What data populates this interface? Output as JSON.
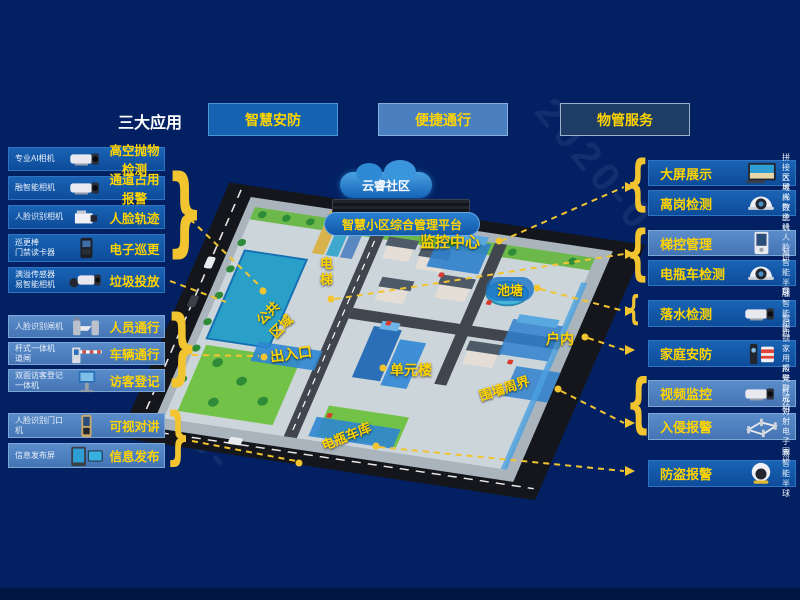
{
  "header": {
    "title": "三大应用",
    "apps": [
      {
        "label": "智慧安防"
      },
      {
        "label": "便捷通行"
      },
      {
        "label": "物管服务"
      }
    ]
  },
  "left_rows": [
    {
      "device": "专业AI相机",
      "icon": "bullet-cam",
      "label": "高空抛物检测",
      "tone": "medium"
    },
    {
      "device": "融智能相机",
      "icon": "bullet-cam",
      "label": "通道占用报警",
      "tone": "medium"
    },
    {
      "device": "人脸识别相机",
      "icon": "box-cam",
      "label": "人脸轨迹",
      "tone": "medium"
    },
    {
      "device": "巡更棒\n门禁读卡器",
      "icon": "reader",
      "label": "电子巡更",
      "tone": "medium"
    },
    {
      "device": "满溢传感器\n易智能相机",
      "icon": "bullet-cam2",
      "label": "垃圾投放",
      "tone": "medium"
    },
    {
      "device": "人脸识别闸机",
      "icon": "turnstile",
      "label": "人员通行",
      "tone": "light"
    },
    {
      "device": "杆式一体机\n道闸",
      "icon": "barrier",
      "label": "车辆通行",
      "tone": "light"
    },
    {
      "device": "双面访客登记\n一体机",
      "icon": "kiosk",
      "label": "访客登记",
      "tone": "light"
    },
    {
      "device": "人脸识别门口机",
      "icon": "doorphone",
      "label": "可视对讲",
      "tone": "light"
    },
    {
      "device": "信息发布屏",
      "icon": "screens",
      "label": "信息发布",
      "tone": "light"
    }
  ],
  "right_rows": [
    {
      "label": "大屏展示",
      "icon": "videowall",
      "device": "拼接大屏",
      "tone": "medium"
    },
    {
      "label": "离岗检测",
      "icon": "dome-cam",
      "device": "区域人数统计",
      "tone": "medium"
    },
    {
      "label": "梯控管理",
      "icon": "panel",
      "device": "梯控主机\n人脸识别门禁",
      "tone": "light"
    },
    {
      "label": "电瓶车检测",
      "icon": "dome-cam",
      "device": "易智能半球",
      "tone": "medium"
    },
    {
      "label": "落水检测",
      "icon": "bullet-cam",
      "device": "融智能相机",
      "tone": "medium"
    },
    {
      "label": "家庭安防",
      "icon": "lock-siren",
      "device": "智能锁\n家用报警器",
      "tone": "medium"
    },
    {
      "label": "视频监控",
      "icon": "bullet-cam",
      "device": "声光警戒相机",
      "tone": "light"
    },
    {
      "label": "入侵报警",
      "icon": "fence",
      "device": "红外对射\n电子围栏",
      "tone": "light"
    },
    {
      "label": "防盗报警",
      "icon": "eyeball-cam",
      "device": "易智能半球",
      "tone": "medium"
    }
  ],
  "map": {
    "cloud": "云睿社区",
    "platform": "智慧小区综合管理平台",
    "labels": {
      "monitor_center": "监控中心",
      "elevator": "电梯",
      "pond": "池塘",
      "public_area": "公共\n区域",
      "entrance": "出入口",
      "unit_building": "单元楼",
      "indoor": "户内",
      "perimeter": "围墙周界",
      "ev_garage": "电瓶车库"
    }
  },
  "braces": {
    "left": "}",
    "right": "{"
  },
  "watermark": {
    "t1": "2020-0",
    "t2": "33-"
  },
  "colors": {
    "background": "#032162",
    "accent_yellow": "#ffd400",
    "connector_yellow": "#f2c430",
    "row_medium": "#0f55a4",
    "row_light": "#4d82c3",
    "btn_security": "#1563b0",
    "btn_access": "#4a80c0",
    "btn_property": "#1d3c66"
  }
}
